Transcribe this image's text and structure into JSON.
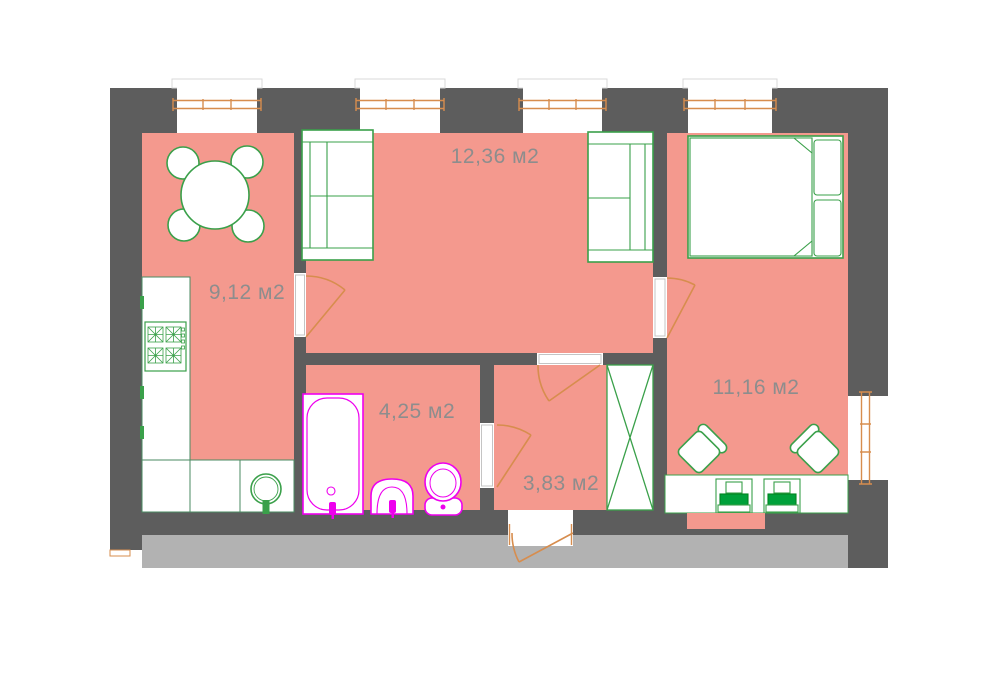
{
  "plan": {
    "type": "apartment-floor-plan",
    "unit": "м2",
    "rooms": {
      "kitchen": {
        "name": "kitchen",
        "label": "9,12 м2"
      },
      "living_room": {
        "name": "living-room",
        "label": "12,36 м2"
      },
      "bathroom": {
        "name": "bathroom",
        "label": "4,25 м2"
      },
      "hallway": {
        "name": "hallway",
        "label": "3,83 м2"
      },
      "bedroom": {
        "name": "bedroom",
        "label": "11,16 м2"
      }
    },
    "furniture": {
      "kitchen": [
        "dining-table",
        "chair",
        "chair",
        "chair",
        "chair",
        "stove",
        "counter",
        "kitchen-sink"
      ],
      "living_room": [
        "sofa",
        "sofa"
      ],
      "bathroom": [
        "bathtub",
        "wash-basin",
        "toilet"
      ],
      "hallway": [
        "wardrobe"
      ],
      "bedroom": [
        "double-bed",
        "pillow",
        "pillow",
        "armchair",
        "armchair",
        "desk",
        "workstation",
        "workstation"
      ]
    },
    "colors": {
      "floor": "#f4998e",
      "walls": "#5d5d5d",
      "ground_strip": "#b2b2b2",
      "furniture_outline": "#3aa04a",
      "keyboard_fill": "#00a13a",
      "plumbing": "#ee00ee",
      "joinery": "#d78d4e",
      "label_text": "#8d8d8d"
    }
  }
}
